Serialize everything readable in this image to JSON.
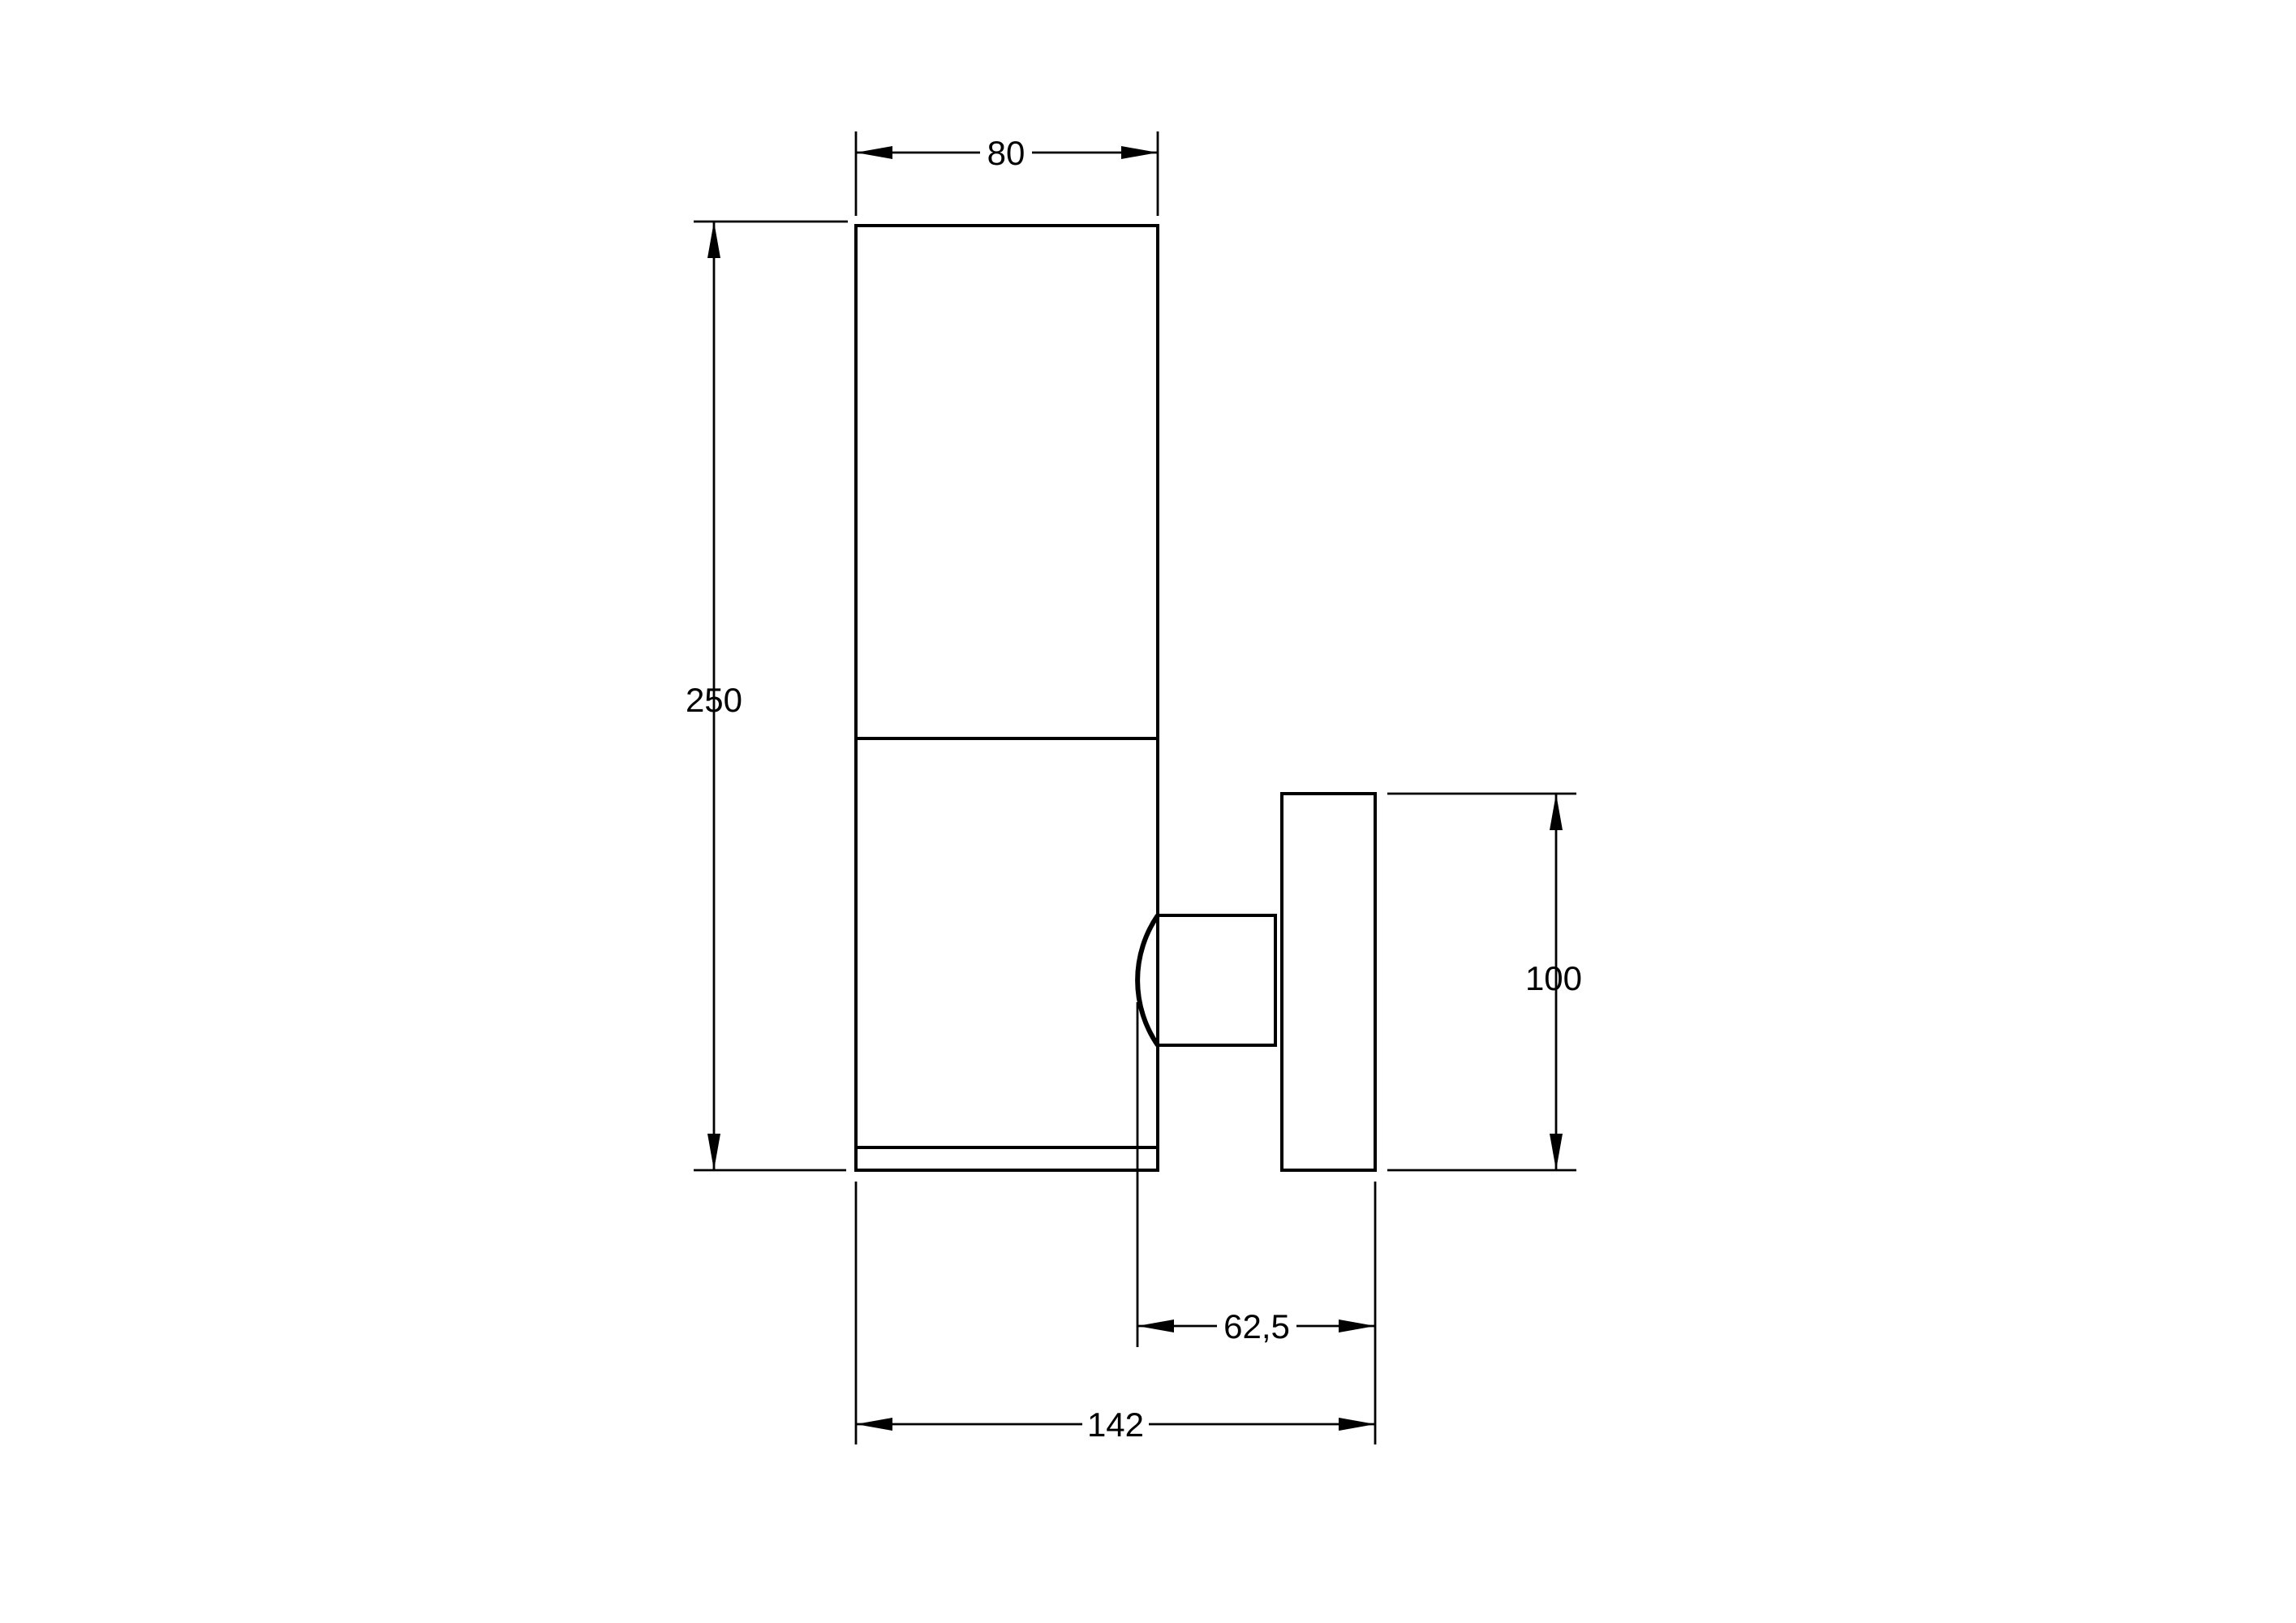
{
  "drawing": {
    "colors": {
      "line": "#000000",
      "background": "#ffffff"
    },
    "dimensions": {
      "body_width": "80",
      "body_height": "250",
      "plate_height": "100",
      "offset_depth": "62,5",
      "total_depth": "142"
    }
  }
}
